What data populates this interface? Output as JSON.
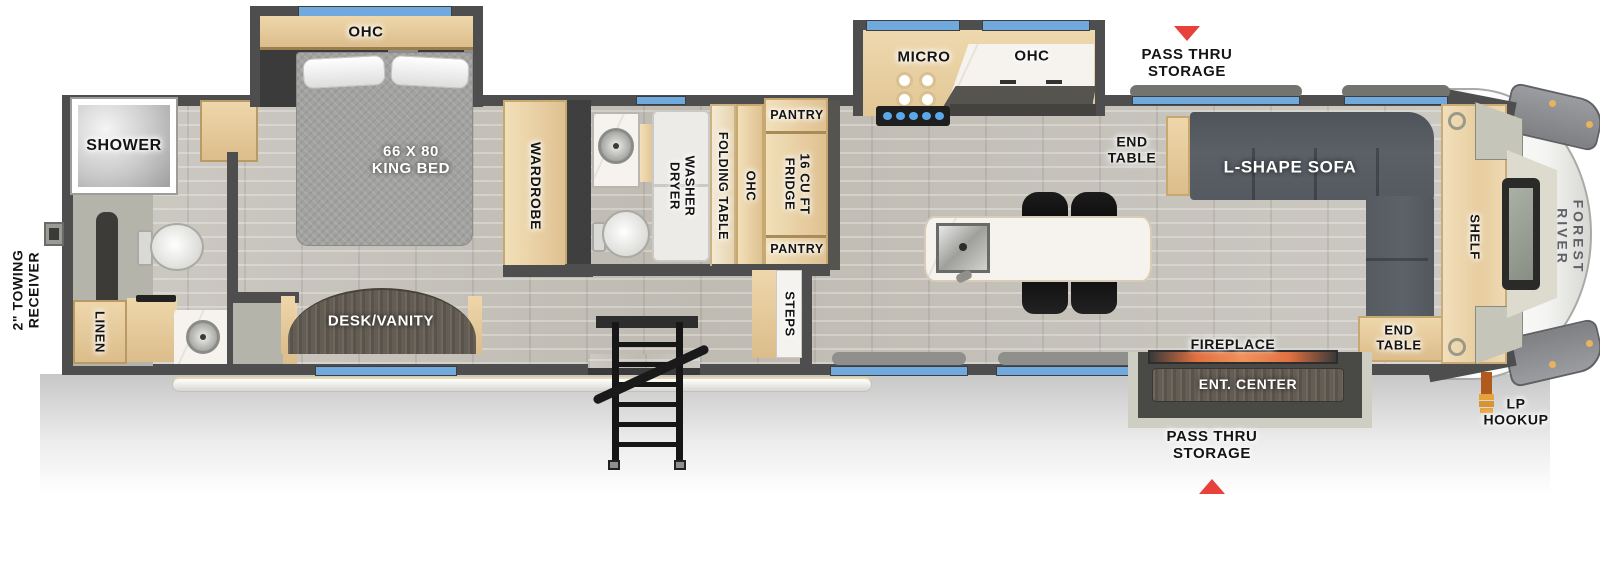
{
  "brand": "FOREST RIVER",
  "exterior": {
    "towing_receiver": "2\" TOWING\nRECEIVER",
    "pass_thru_storage_top": "PASS THRU\nSTORAGE",
    "pass_thru_storage_bottom": "PASS THRU\nSTORAGE",
    "lp_hookup": "LP\nHOOKUP"
  },
  "rear_bath": {
    "shower": "SHOWER",
    "linen": "LINEN"
  },
  "bedroom": {
    "ohc": "OHC",
    "bed": "66 X 80\nKING BED",
    "wardrobe": "WARDROBE",
    "desk_vanity": "DESK/VANITY"
  },
  "mid_bath": {
    "washer_dryer": "WASHER\nDRYER",
    "folding_table": "FOLDING TABLE",
    "ohc": "OHC",
    "steps": "STEPS"
  },
  "kitchen": {
    "micro": "MICRO",
    "ohc": "OHC",
    "pantry_top": "PANTRY",
    "fridge": "16 CU FT\nFRIDGE",
    "pantry_bottom": "PANTRY"
  },
  "living": {
    "end_table_kitchen": "END\nTABLE",
    "sofa": "L-SHAPE SOFA",
    "fireplace": "FIREPLACE",
    "ent_center": "ENT. CENTER",
    "end_table_front": "END\nTABLE",
    "shelf": "SHELF"
  },
  "colors": {
    "wall": "#4e4e4e",
    "window_blue": "#6fa9dd",
    "accent_red": "#e8403a",
    "wood": "#e9d2a6",
    "floor": "#c6c3bc"
  }
}
